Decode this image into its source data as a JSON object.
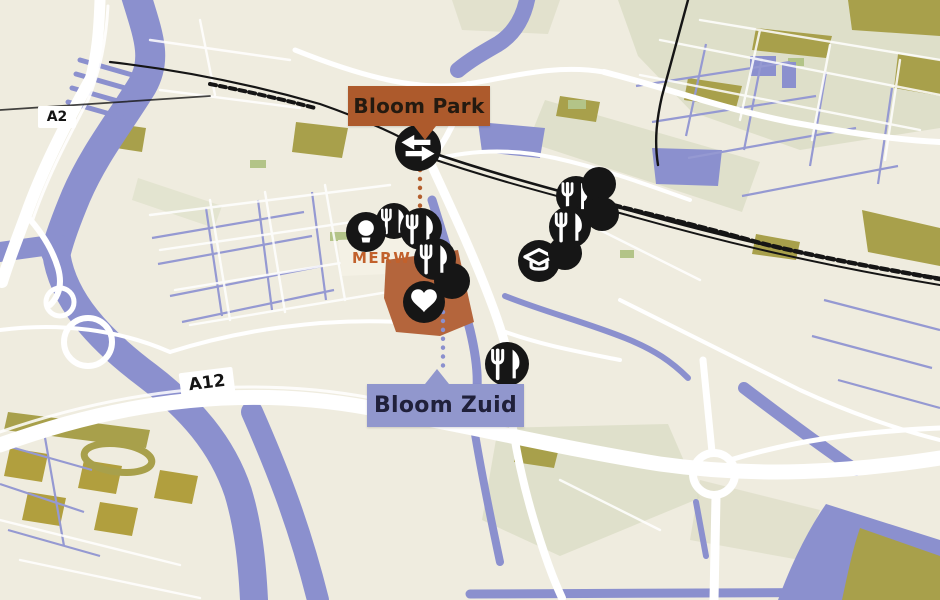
{
  "labels": {
    "park": {
      "text": "Bloom Park"
    },
    "zuid": {
      "text": "Bloom Zuid"
    },
    "district": {
      "text": "MERW"
    },
    "roads": {
      "a2": "A2",
      "a12": "A12"
    }
  },
  "colors": {
    "map_background": "#efecdf",
    "water": "#8b90ce",
    "street_purple": "#9599d2",
    "olive": "#a8a04b",
    "gold": "#b19f3e",
    "sage": "#d8dbc2",
    "road_white": "#ffffff",
    "rail_black": "#151515",
    "marker_bg": "#161616",
    "marker_icon": "#ffffff",
    "label_park_bg": "#ad5a2c",
    "label_park_text": "#241a10",
    "label_zuid_bg": "#9197cd",
    "label_zuid_text": "#20203a",
    "district_fill": "#b4653c",
    "district_text": "#c2612c",
    "connector_orange": "#b45f2e",
    "connector_blue": "#8b90ce"
  },
  "markers": [
    {
      "name": "station-marker",
      "icon": "transit-icon",
      "x": 418,
      "y": 148,
      "r": 23
    },
    {
      "name": "poi-marker",
      "icon": "fork-knife-icon",
      "x": 394,
      "y": 221,
      "r": 18
    },
    {
      "name": "poi-marker",
      "icon": "lightbulb-icon",
      "x": 366,
      "y": 232,
      "r": 20
    },
    {
      "name": "poi-marker",
      "icon": "fork-knife-icon",
      "x": 421,
      "y": 229,
      "r": 21
    },
    {
      "name": "poi-marker",
      "icon": "dot-icon",
      "x": 452,
      "y": 281,
      "r": 18
    },
    {
      "name": "poi-marker",
      "icon": "fork-knife-icon",
      "x": 435,
      "y": 259,
      "r": 21
    },
    {
      "name": "poi-marker",
      "icon": "heart-icon",
      "x": 424,
      "y": 302,
      "r": 21
    },
    {
      "name": "poi-marker",
      "icon": "fork-knife-icon",
      "x": 576,
      "y": 196,
      "r": 20
    },
    {
      "name": "poi-marker",
      "icon": "dot-icon",
      "x": 599,
      "y": 184,
      "r": 17
    },
    {
      "name": "poi-marker",
      "icon": "dot-icon",
      "x": 602,
      "y": 214,
      "r": 17
    },
    {
      "name": "poi-marker",
      "icon": "graduation-cap-icon",
      "x": 539,
      "y": 261,
      "r": 21
    },
    {
      "name": "poi-marker",
      "icon": "dot-icon",
      "x": 565,
      "y": 253,
      "r": 17
    },
    {
      "name": "poi-marker",
      "icon": "fork-knife-icon",
      "x": 570,
      "y": 227,
      "r": 21
    },
    {
      "name": "poi-marker",
      "icon": "fork-knife-icon",
      "x": 507,
      "y": 364,
      "r": 22
    }
  ],
  "connectors": [
    {
      "name": "park-connector",
      "color": "#b45f2e",
      "x": 420,
      "y1": 170,
      "y2": 212
    },
    {
      "name": "zuid-connector",
      "color": "#8b90ce",
      "x": 443,
      "y1": 312,
      "y2": 366
    }
  ]
}
